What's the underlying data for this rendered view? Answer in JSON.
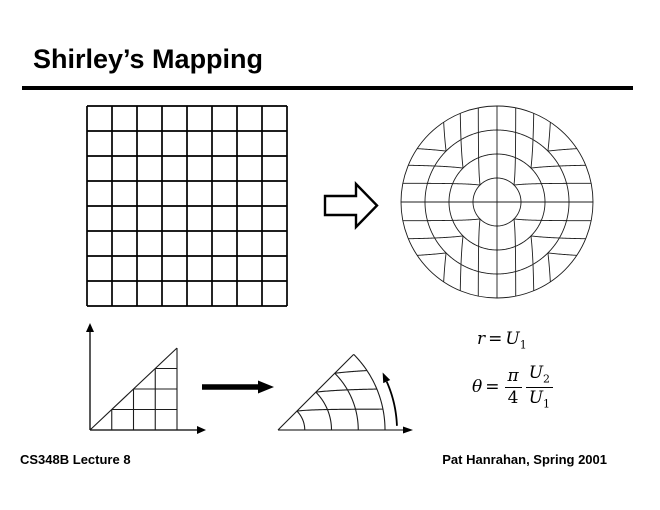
{
  "title": "Shirley’s Mapping",
  "footer": {
    "left": "CS348B Lecture 8",
    "right": "Pat Hanrahan, Spring 2001"
  },
  "equations": {
    "eq1": {
      "lhs": "r",
      "rel": "=",
      "rhs_base": "U",
      "rhs_sub": "1"
    },
    "eq2": {
      "lhs": "θ",
      "rel": "=",
      "frac1": {
        "num": "π",
        "den": "4"
      },
      "frac2": {
        "num_base": "U",
        "num_sub": "2",
        "den_base": "U",
        "den_sub": "1"
      }
    }
  },
  "figures": {
    "square_grid": {
      "divisions": 8
    },
    "disk_grid": {
      "divisions": 8,
      "rings": 4
    },
    "triangle_grid": {
      "divisions": 4
    },
    "sector_grid": {
      "divisions": 4,
      "angle_deg": 45
    },
    "arrows": {
      "square_to_disk": "block-arrow-right",
      "triangle_to_sector": "solid-arrow-right",
      "sector_angle": "curved-arrow-counterclockwise"
    }
  },
  "colors": {
    "ink": "#000000",
    "figure_line": "#1c1c1c",
    "background": "#ffffff"
  }
}
